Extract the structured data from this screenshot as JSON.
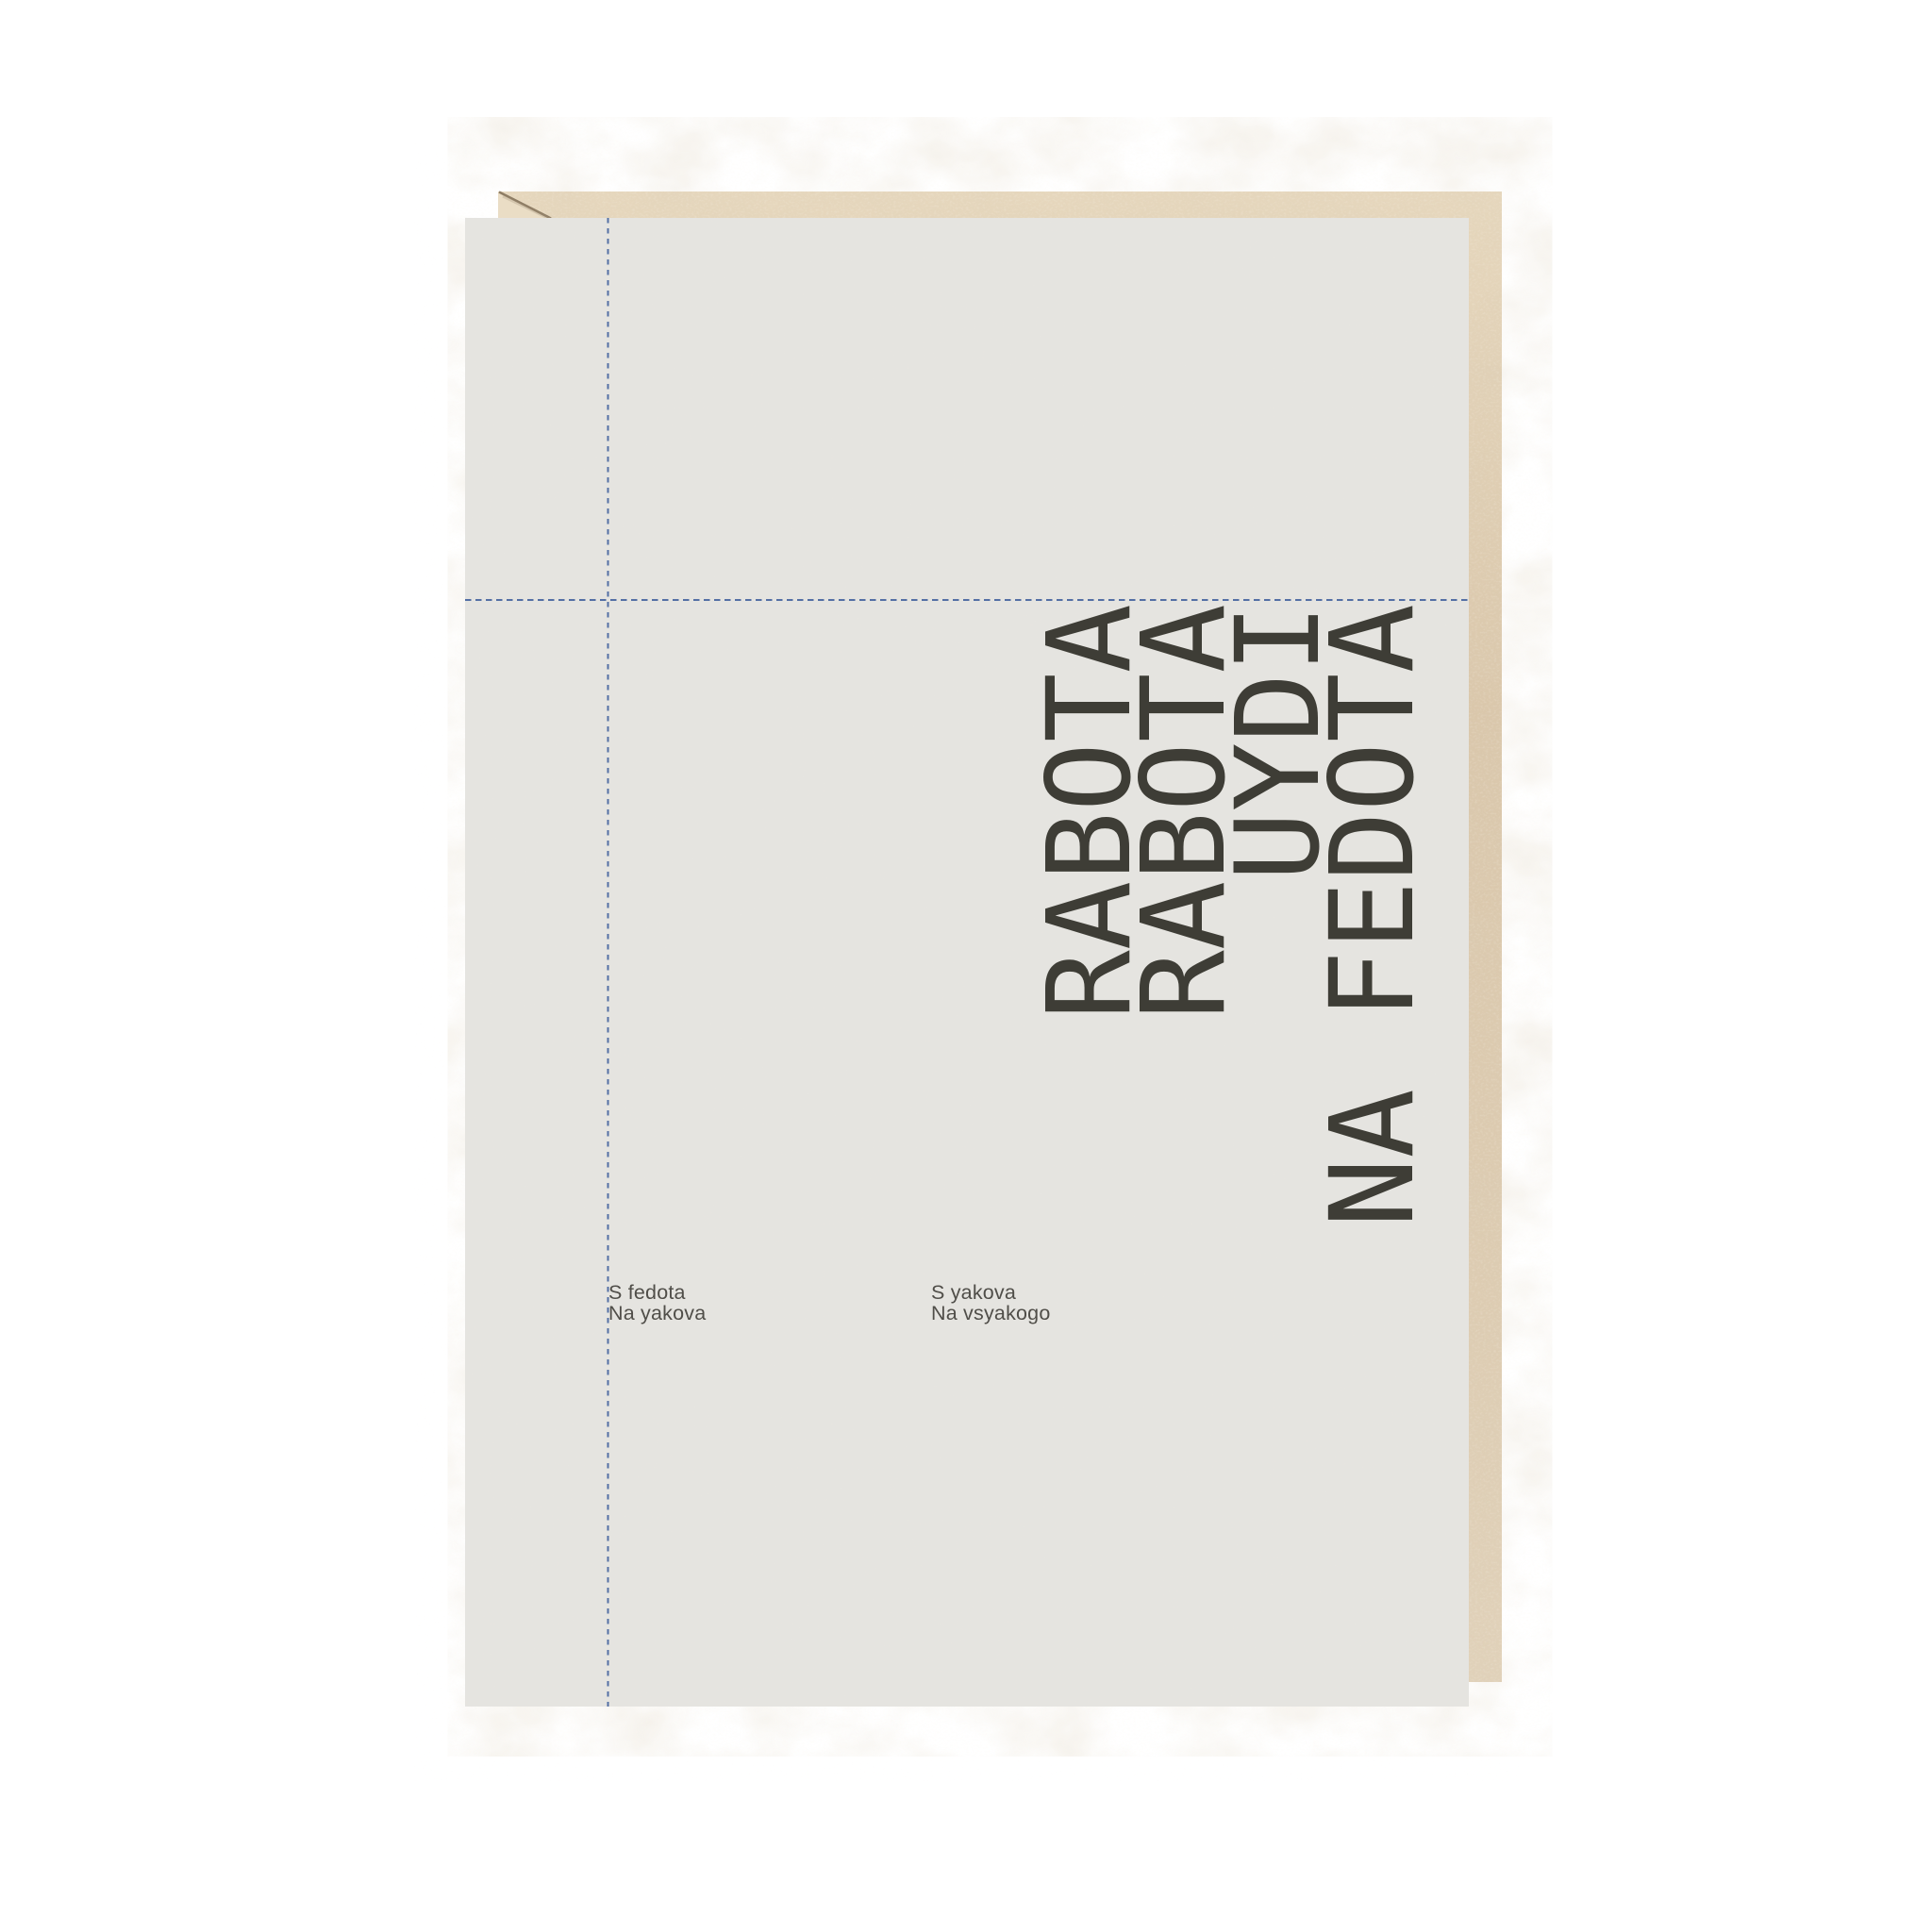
{
  "artboard": {
    "background_color": "#ffffff"
  },
  "kraft_card": {
    "base_color": "#dccab0",
    "mottle_color": "#b39b77",
    "fiber_color": "#f4ecdc",
    "folded_corner_color": "#eaddc5",
    "crease_color": "#8d7c64"
  },
  "front_panel": {
    "color": "#e5e4e0"
  },
  "guides": {
    "color": "#44639f"
  },
  "headline": {
    "color": "#3e3d36",
    "lines": [
      "RABOTA",
      "RABOTA",
      "UYDI",
      "NA FEDOTA"
    ]
  },
  "captions": {
    "color": "#504e49",
    "left": [
      "S fedota",
      "Na yakova"
    ],
    "right": [
      "S yakova",
      "Na vsyakogo"
    ]
  }
}
